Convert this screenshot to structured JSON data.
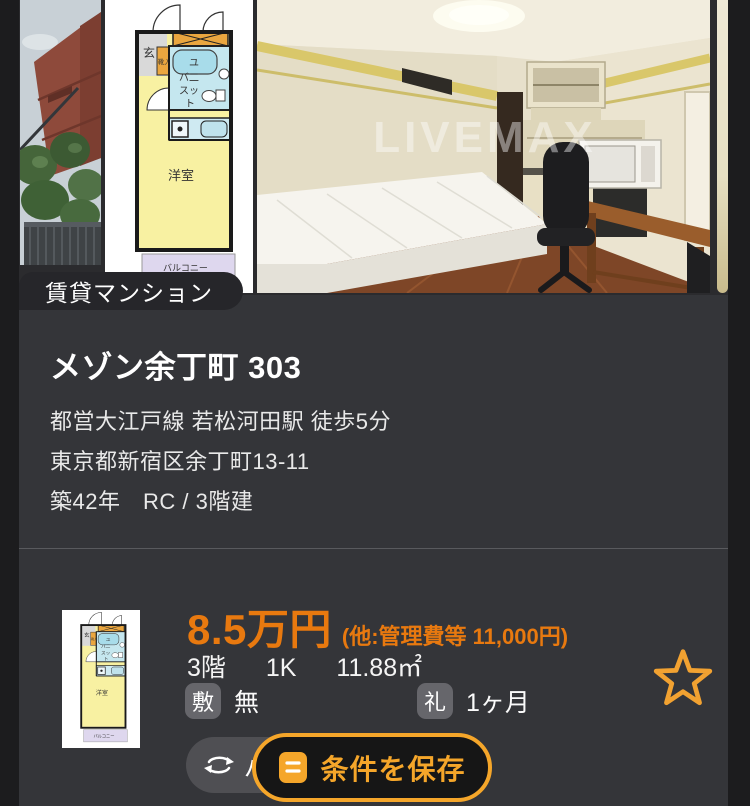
{
  "colors": {
    "page_bg": "#1c1c1e",
    "card_bg": "#343539",
    "rent_orange": "#e8790f",
    "accent_orange": "#f5a62a"
  },
  "gallery": {
    "type_badge": "賃貸マンション",
    "watermark": "LIVEMAX",
    "floorplan_labels": {
      "entrance": "玄",
      "shoe_box": "靴入",
      "bath1": "ユ",
      "bath2": "バ二",
      "bath3": "スッ",
      "bath4": "ト",
      "room": "洋室",
      "balcony": "バルコニー"
    }
  },
  "listing": {
    "title": "メゾン余丁町 303",
    "access": "都営大江戸線 若松河田駅 徒歩5分",
    "address": "東京都新宿区余丁町13-11",
    "age_structure": "築42年　RC / 3階建"
  },
  "offer": {
    "rent": "8.5万円",
    "rent_note": "(他:管理費等 11,000円)",
    "floor": "3階",
    "layout": "1K",
    "area": "11.88㎡",
    "deposit_label": "敷",
    "deposit_value": "無",
    "key_money_label": "礼",
    "key_money_value": "1ヶ月",
    "tag_text": "パ"
  },
  "actions": {
    "save_label": "条件を保存"
  }
}
